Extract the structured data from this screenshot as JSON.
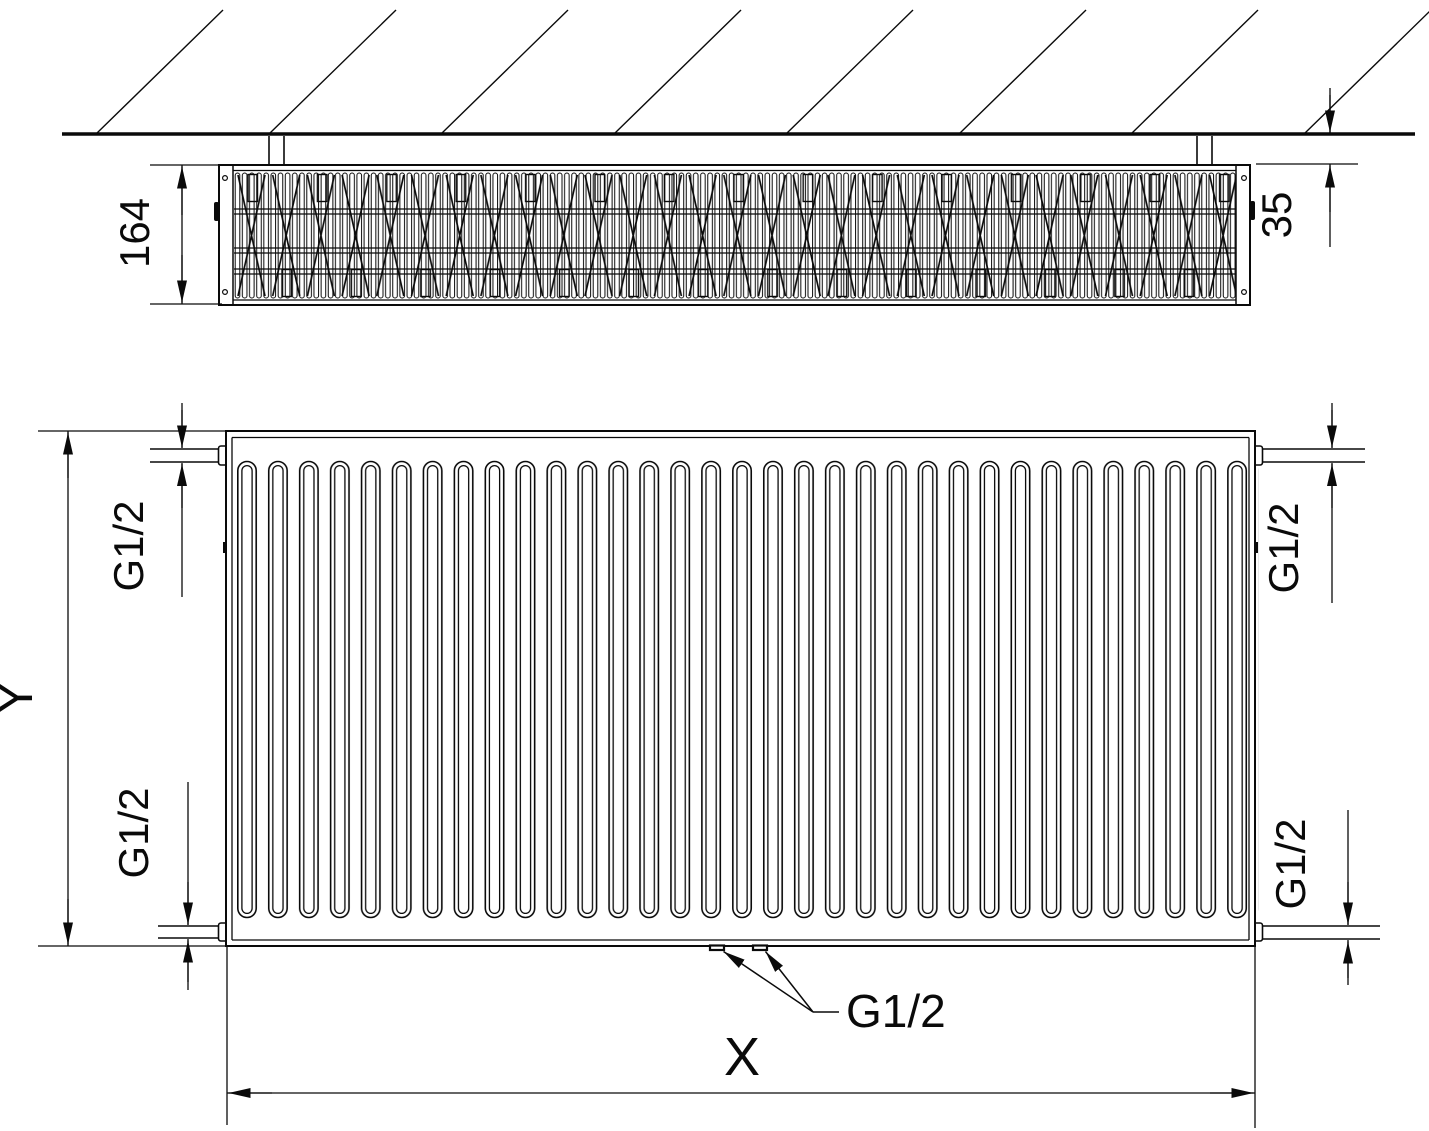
{
  "diagram": {
    "type": "technical-drawing",
    "views": {
      "top_view": "radiator section at wall",
      "front_view": "radiator front elevation"
    },
    "labels": {
      "top_depth": "164",
      "wall_gap": "35",
      "height": "Y",
      "width": "X",
      "conn_top_left": "G1/2",
      "conn_top_right": "G1/2",
      "conn_bottom_left": "G1/2",
      "conn_bottom_right": "G1/2",
      "conn_bottom_center": "G1/2"
    },
    "colors": {
      "line": "#0a0a0a",
      "background": "#ffffff"
    }
  }
}
